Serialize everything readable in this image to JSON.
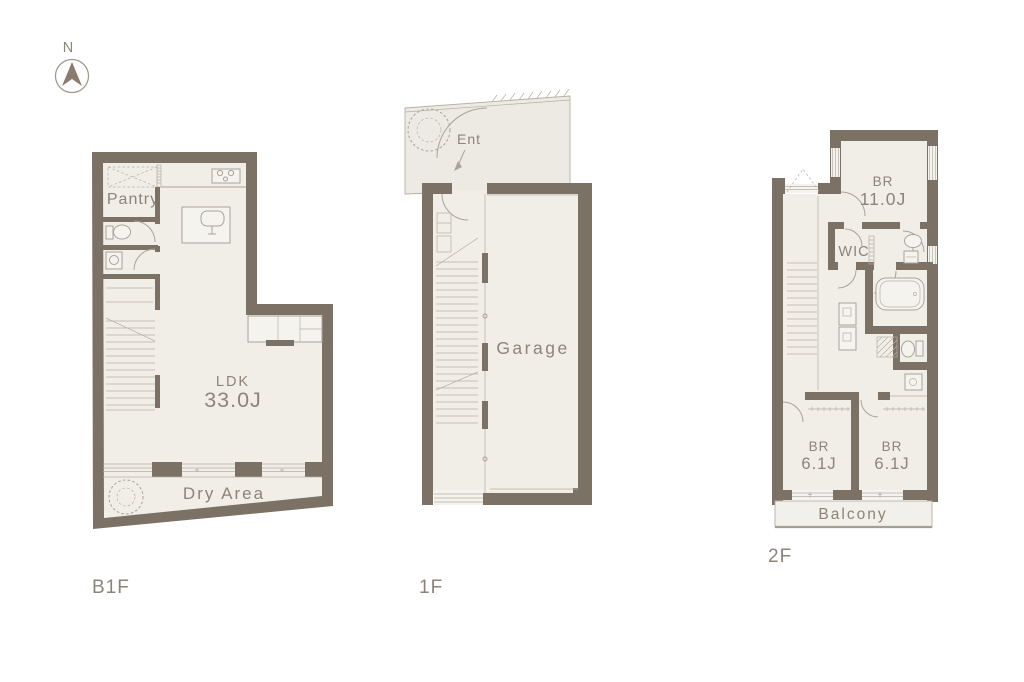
{
  "colors": {
    "wall": "#7b7164",
    "floor": "#f1eee8",
    "slab": "#eceae3",
    "line": "#b6b0a5",
    "fixline": "#a9a399",
    "text": "#8b8479",
    "window_fill": "#f5f3ee",
    "arrow": "#8a7c6d",
    "balcony": "#f2f0ea",
    "rail": "#a59f94",
    "background": "#ffffff"
  },
  "north": {
    "label": "N"
  },
  "icons": {
    "north-arrow-icon": "triangle-up-in-circle",
    "tree-icon": "scalloped-circle",
    "entrance-arrow-icon": "down-left-arrow"
  },
  "floors": {
    "b1f": {
      "label": "B1F",
      "rooms": {
        "pantry": "Pantry",
        "ldk_name": "LDK",
        "ldk_size": "33.0J",
        "dry_area": "Dry Area"
      }
    },
    "f1": {
      "label": "1F",
      "rooms": {
        "entrance": "Ent",
        "garage": "Garage"
      }
    },
    "f2": {
      "label": "2F",
      "rooms": {
        "br_main_name": "BR",
        "br_main_size": "11.0J",
        "wic": "WIC",
        "br_left_name": "BR",
        "br_left_size": "6.1J",
        "br_right_name": "BR",
        "br_right_size": "6.1J",
        "balcony": "Balcony"
      }
    }
  }
}
